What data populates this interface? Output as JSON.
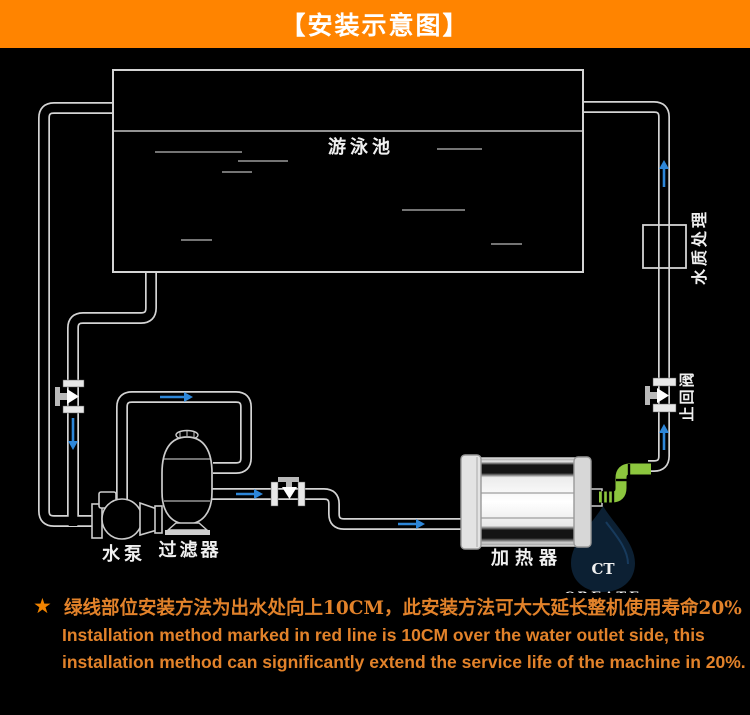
{
  "header": {
    "title": "【安装示意图】",
    "bg_color": "#ff8400",
    "text_color": "#ffffff"
  },
  "diagram": {
    "bg_color": "#000000",
    "labels": {
      "pool": "游泳池",
      "pump": "水泵",
      "filter": "过滤器",
      "heater": "加热器",
      "water_treatment": "水质处理",
      "check_valve": "止回阀"
    },
    "colors": {
      "pipe_outline": "#d4d4d4",
      "flow_arrow_blue": "#2d86d8",
      "green_pipe": "#8cc63e"
    },
    "watermark": {
      "initials": "CT",
      "name": "CREATE"
    }
  },
  "notes": {
    "bullet": "★",
    "line1_zh": "绿线部位安装方法为出水处向上10CM，此安装方法可大大延长整机使用寿命20%",
    "line2_en": "Installation method marked in red line is 10CM over the water outlet side, this",
    "line3_en": "installation method can significantly extend the service life of the machine in 20%.",
    "text_color": "#e2822a"
  }
}
